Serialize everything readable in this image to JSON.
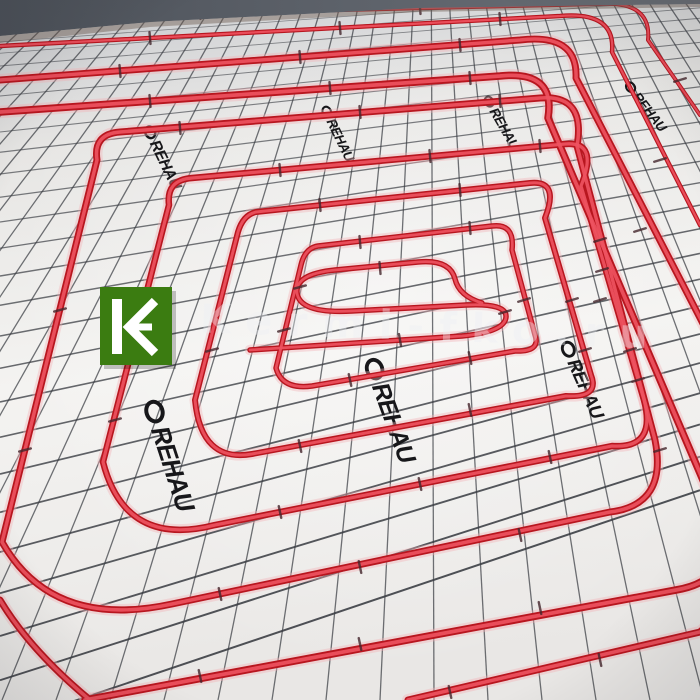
{
  "image": {
    "alt": "REHAU red PEX heating pipe spiral fixed on white gridded insulation board"
  },
  "watermark": {
    "text": "Kermi-fko.ru",
    "color": "#eef0f4",
    "opacity": 0.4
  },
  "logo": {
    "bg": "#3b7c11",
    "fg": "#ffffff",
    "glyph": "kermi-k-arrow"
  },
  "brand": {
    "label": "REHAU",
    "text_color": "#17171a"
  },
  "scene": {
    "wall_color": "#575c64",
    "wall_edge_color": "#6e5d52",
    "board_top": "#c6c8cc",
    "board_mid": "#f2f1ef",
    "board_bot": "#e9e7e5",
    "grid_color": "#3a3d43",
    "pipe_base": "#b8161f",
    "pipe_core": "#ee5360",
    "pipe_glow": "#f3b2b6",
    "clip_color": "#44262c",
    "grid": {
      "row_count": 27,
      "row_a": 24,
      "row_b": 7.5,
      "row_c": 0.75,
      "row_k": 0.7308,
      "row_off": -40.4,
      "col_count": 38,
      "col_start": -700,
      "col_step": 54,
      "col_k": 0.3333,
      "col_off": 286.7
    },
    "pipes": [
      {
        "d": "M0,18 L600,4 Q652,1 648,40 L700,115",
        "w": 4
      },
      {
        "d": "M0,46 L560,16 Q616,11 612,52 L700,225",
        "w": 4.5
      },
      {
        "d": "M0,80 L520,40 Q578,33 576,78 L758,430 Q782,530 735,600 L700,632 L408,700",
        "w": 7
      },
      {
        "d": "M0,112 L500,76 Q556,70 548,118 L720,520 Q736,580 676,590 L85,700",
        "w": 7.5
      },
      {
        "d": "M97,160 Q93,134 120,132 L540,98 Q586,94 577,146 L655,440 Q668,505 610,512 L172,604 Q52,630 2,542 Z",
        "w": 7
      },
      {
        "d": "M169,205 Q166,180 192,178 L565,144 Q599,141 581,186 L644,400 Q657,449 612,446 L215,525 Q125,548 103,462 Z",
        "w": 6.5
      },
      {
        "d": "M238,232 Q243,215 256,212 L530,183 Q560,180 545,218 L591,375 Q600,398 566,396 L252,454 Q201,463 195,400 Z",
        "w": 6
      },
      {
        "d": "M301,265 Q305,248 318,246 L492,226 Q515,223 512,250 L535,335 Q541,352 515,351 L312,386 Q282,390 276,368 Z",
        "w": 5.5
      },
      {
        "d": "M250,350 L462,336 Q505,332 506,317 Q507,303 466,305 L352,311 Q300,314 297,293 Q295,274 335,270 L418,262 Q450,259 455,279 Q459,296 482,303",
        "w": 5.5
      },
      {
        "d": "M0,600 Q30,650 90,700",
        "w": 7
      }
    ],
    "labels": [
      {
        "x": 148,
        "y": 128,
        "rot": 64,
        "s": 0.6
      },
      {
        "x": 325,
        "y": 108,
        "rot": 64,
        "s": 0.52
      },
      {
        "x": 487,
        "y": 98,
        "rot": 60,
        "s": 0.52
      },
      {
        "x": 628,
        "y": 84,
        "rot": 52,
        "s": 0.52
      },
      {
        "x": 372,
        "y": 362,
        "rot": 70,
        "s": 0.95
      },
      {
        "x": 566,
        "y": 344,
        "rot": 66,
        "s": 0.72
      },
      {
        "x": 152,
        "y": 404,
        "rot": 72,
        "s": 1.0
      }
    ],
    "clips": [
      [
        200,
        13,
        85
      ],
      [
        420,
        8,
        85
      ],
      [
        150,
        38,
        85
      ],
      [
        340,
        28,
        85
      ],
      [
        500,
        19,
        85
      ],
      [
        120,
        71,
        85
      ],
      [
        300,
        57,
        85
      ],
      [
        460,
        45,
        85
      ],
      [
        150,
        101,
        85
      ],
      [
        330,
        88,
        85
      ],
      [
        470,
        78,
        85
      ],
      [
        180,
        128,
        85
      ],
      [
        360,
        112,
        85
      ],
      [
        500,
        101,
        85
      ],
      [
        280,
        170,
        85
      ],
      [
        430,
        156,
        85
      ],
      [
        540,
        146,
        85
      ],
      [
        320,
        205,
        85
      ],
      [
        460,
        190,
        85
      ],
      [
        360,
        242,
        85
      ],
      [
        470,
        228,
        85
      ],
      [
        350,
        380,
        78
      ],
      [
        470,
        358,
        78
      ],
      [
        300,
        446,
        78
      ],
      [
        470,
        410,
        78
      ],
      [
        280,
        512,
        78
      ],
      [
        420,
        484,
        78
      ],
      [
        550,
        457,
        78
      ],
      [
        220,
        594,
        78
      ],
      [
        360,
        567,
        78
      ],
      [
        520,
        535,
        78
      ],
      [
        200,
        676,
        78
      ],
      [
        360,
        644,
        78
      ],
      [
        540,
        608,
        78
      ],
      [
        450,
        692,
        78
      ],
      [
        600,
        660,
        78
      ],
      [
        284,
        330,
        -15
      ],
      [
        212,
        350,
        -15
      ],
      [
        135,
        330,
        -15
      ],
      [
        115,
        420,
        -15
      ],
      [
        60,
        310,
        -15
      ],
      [
        25,
        450,
        -15
      ],
      [
        524,
        300,
        -17
      ],
      [
        572,
        300,
        -17
      ],
      [
        585,
        350,
        -17
      ],
      [
        602,
        270,
        -17
      ],
      [
        630,
        350,
        -17
      ],
      [
        600,
        240,
        -17
      ],
      [
        638,
        380,
        -17
      ],
      [
        600,
        300,
        -17
      ],
      [
        660,
        450,
        -17
      ],
      [
        640,
        230,
        -17
      ],
      [
        660,
        160,
        -17
      ],
      [
        680,
        80,
        -17
      ],
      [
        380,
        268,
        85
      ],
      [
        300,
        287,
        -15
      ],
      [
        505,
        312,
        -17
      ],
      [
        400,
        340,
        80
      ]
    ]
  }
}
